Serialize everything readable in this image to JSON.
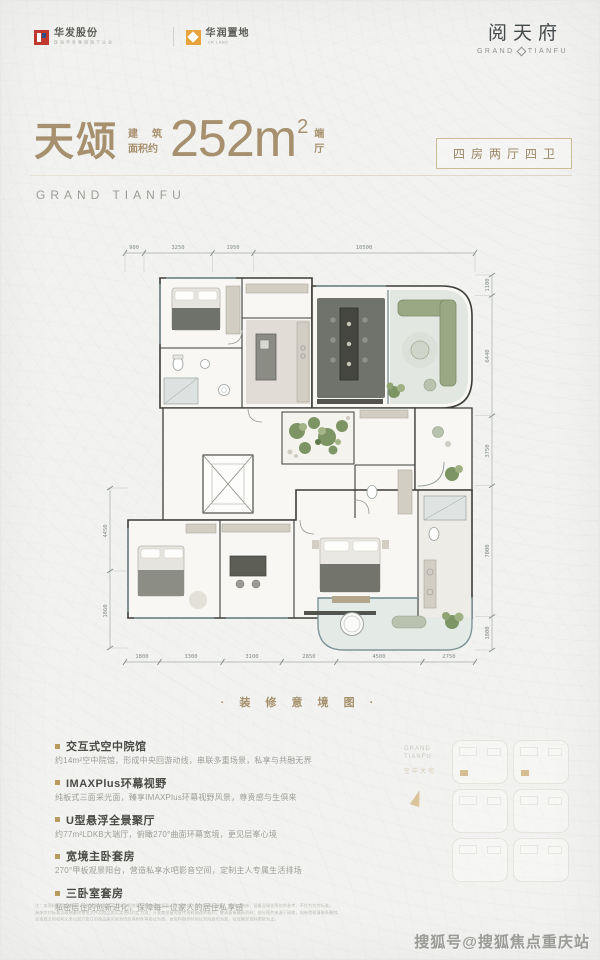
{
  "colors": {
    "accent": "#a6906e",
    "gold": "#b99a5f",
    "logo_red": "#c0392e",
    "logo_orange": "#e8a33d",
    "glass_teal": "#7f9599",
    "plant_green": "#7d9464"
  },
  "header": {
    "logo1": {
      "cn": "华发股份",
      "sub": "珠 海 华 发 集 团 旗 下 企 业"
    },
    "logo2": {
      "cn": "华润置地",
      "sub": "CR LAND"
    },
    "brand": {
      "cn": "阅天府",
      "en1": "GRAND",
      "en2": "TIANFU"
    }
  },
  "title": {
    "name": "天颂",
    "prefix1": "建筑",
    "prefix2": "面积约",
    "value": "252m",
    "sup": "2",
    "suffix1": "端",
    "suffix2": "厅",
    "badge": "四房两厅四卫",
    "brand_en": "GRAND TIANFU"
  },
  "floorplan": {
    "caption": "· 装 修 意 境 图 ·",
    "dims_top": [
      "900",
      "3250",
      "1950",
      "10500"
    ],
    "dims_bottom": [
      "1800",
      "3300",
      "3100",
      "2850",
      "4500",
      "2750"
    ],
    "dims_right": [
      "1100",
      "6440",
      "3750",
      "7000",
      "1800"
    ],
    "dims_left": [
      "4450",
      "1860"
    ]
  },
  "features": [
    {
      "title": "交互式空中院馆",
      "desc": "约14m²空中院馆，形成中央回游动线，串联多重场景，私享与共融无界"
    },
    {
      "title": "IMAXPlus环幕视野",
      "desc": "纯板式三面采光面，臻享IMAXPlus环幕视野风景，尊贵感与生俱来"
    },
    {
      "title": "U型悬浮全景聚厅",
      "desc": "约77m²LDKB大端厅，俯瞰270°曲面环幕宽境，更见层峯心境"
    },
    {
      "title": "宽境主卧套房",
      "desc": "270°甲板观景阳台，营造私享水吧影音空间，定制主人专属生活排场"
    },
    {
      "title": "三卧室套房",
      "desc": "私密居住的创新进化，保障每一位家人的居住私享感"
    }
  ],
  "keyplan": {
    "brand1": "GRAND",
    "brand2": "TIANFU",
    "chars": "空中大宅"
  },
  "footer": {
    "disclaimer1": "注：本资料为要约邀请，不构成要约或承诺；文中相关面积均为建筑面积，户型图仅为装修意境示意图，家具、装饰、设备及绿化等仅供参考，不作为交付标准。",
    "disclaimer2": "具体交付标准以政府最终审批文件及商品房买卖合同约定为准；开发商保留对宣传资料修改的权利，敬请留意最新资料；部分图片来源于网络，如有侵权请联系删除。",
    "disclaimer3": "买卖双方的权利义务以双方签订的商品房买卖合同及其附件等协议为准。本资料制作时间以实际发布为准，有效期至资料更新为止。",
    "watermark": "搜狐号@搜狐焦点重庆站"
  }
}
